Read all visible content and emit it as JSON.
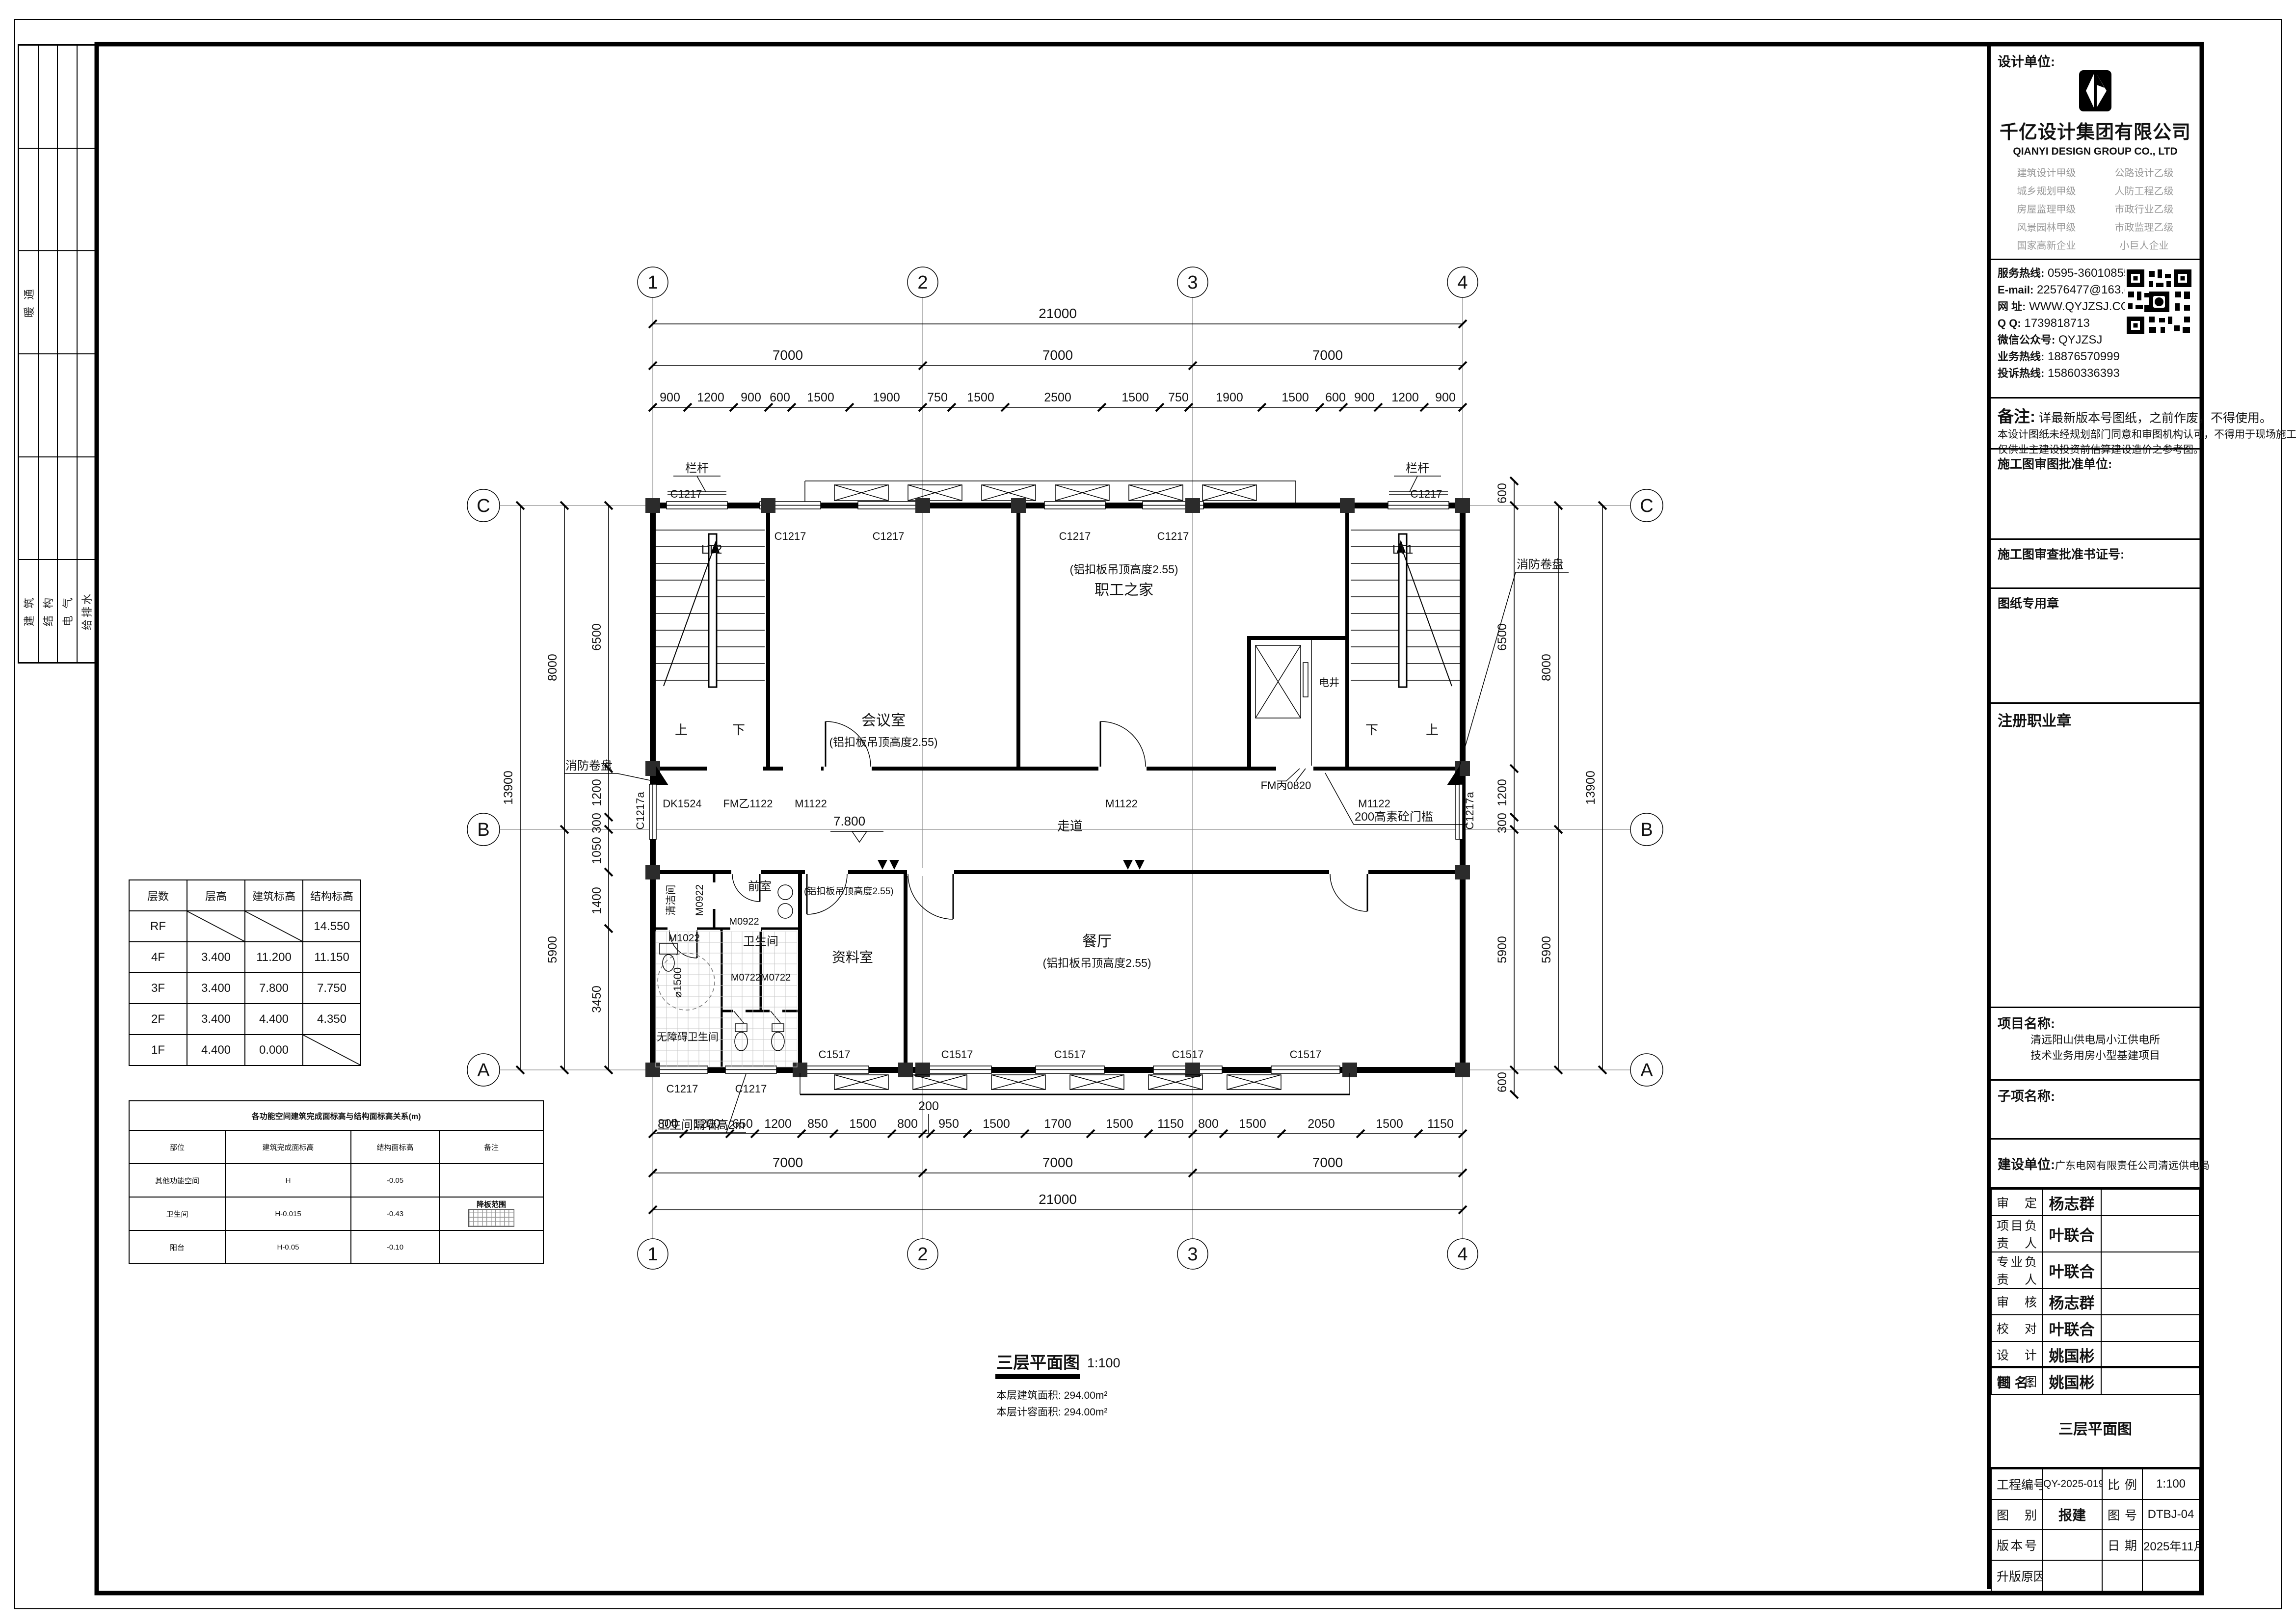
{
  "strip": {
    "hvac": "暖 通",
    "disciplines": [
      "建 筑",
      "结 构",
      "电 气",
      "给排水"
    ]
  },
  "title_block": {
    "design_unit_label": "设计单位:",
    "company_cn": "千亿设计集团有限公司",
    "company_en": "QIANYI DESIGN GROUP CO., LTD",
    "quals_left": [
      "建筑设计甲级",
      "城乡规划甲级",
      "房屋监理甲级",
      "风景园林甲级",
      "国家高新企业"
    ],
    "quals_right": [
      "公路设计乙级",
      "人防工程乙级",
      "市政行业乙级",
      "市政监理乙级",
      "小巨人企业"
    ],
    "contact": {
      "service_label": "服务热线:",
      "service": "0595-36010855",
      "email_label": "E-mail:",
      "email": "22576477@163.com",
      "web_label": "网 址:",
      "web": "WWW.QYJZSJ.COM",
      "qq_label": "Q Q:",
      "qq": "1739818713",
      "wechat_label": "微信公众号:",
      "wechat": "QYJZSJ",
      "biz_label": "业务热线:",
      "biz": "18876570999",
      "complaint_label": "投诉热线:",
      "complaint": "15860336393"
    },
    "remark_label": "备注:",
    "remark1": "详最新版本号图纸，之前作废，不得使用。",
    "remark2": "本设计图纸未经规划部门同意和审图机构认可，不得用于现场施工，",
    "remark3": "仅供业主建设投资前估算建设造价之参考图。",
    "approval_unit_label": "施工图审图批准单位:",
    "approval_no_label": "施工图审查批准书证号:",
    "seal_label": "图纸专用章",
    "reg_seal_label": "注册职业章",
    "project_label": "项目名称:",
    "project_line1": "清远阳山供电局小江供电所",
    "project_line2": "技术业务用房小型基建项目",
    "subproject_label": "子项名称:",
    "client_label": "建设单位:",
    "client": "广东电网有限责任公司清远供电局",
    "personnel": [
      {
        "role": "审定",
        "name": "杨志群"
      },
      {
        "role": "项目负责人",
        "name": "叶联合"
      },
      {
        "role": "专业负责人",
        "name": "叶联合"
      },
      {
        "role": "审核",
        "name": "杨志群"
      },
      {
        "role": "校对",
        "name": "叶联合"
      },
      {
        "role": "设计",
        "name": "姚国彬"
      },
      {
        "role": "制图",
        "name": "姚国彬"
      }
    ],
    "drawing_name_label": "图  名:",
    "drawing_name": "三层平面图",
    "bottom": {
      "project_no_label": "工程编号",
      "project_no": "QY-2025-019",
      "scale_label": "比例",
      "scale": "1:100",
      "category_label": "图别",
      "category": "报建",
      "no_label": "图号",
      "no": "DTBJ-04",
      "version_label": "版本号",
      "version": "",
      "date_label": "日期",
      "date": "2025年11月",
      "revision_label": "升版原因"
    }
  },
  "tables": {
    "floor": {
      "headers": [
        "层数",
        "层高",
        "建筑标高",
        "结构标高"
      ],
      "rows": [
        [
          "RF",
          "",
          "",
          "14.550"
        ],
        [
          "4F",
          "3.400",
          "11.200",
          "11.150"
        ],
        [
          "3F",
          "3.400",
          "7.800",
          "7.750"
        ],
        [
          "2F",
          "3.400",
          "4.400",
          "4.350"
        ],
        [
          "1F",
          "4.400",
          "0.000",
          ""
        ]
      ]
    },
    "relation": {
      "title": "各功能空间建筑完成面标高与结构面标高关系(m)",
      "headers": [
        "部位",
        "建筑完成面标高",
        "结构面标高",
        "备注"
      ],
      "rows": [
        [
          "其他功能空间",
          "H",
          "-0.05",
          ""
        ],
        [
          "卫生间",
          "H-0.015",
          "-0.43",
          "降板范围"
        ],
        [
          "阳台",
          "H-0.05",
          "-0.10",
          ""
        ]
      ]
    }
  },
  "plan": {
    "title": "三层平面图",
    "scale": "1:100",
    "area1": "本层建筑面积: 294.00m²",
    "area2": "本层计容面积: 294.00m²",
    "grid_top": [
      "1",
      "2",
      "3",
      "4"
    ],
    "grid_side": [
      "C",
      "B",
      "A"
    ],
    "dim_total": "21000",
    "dim_bay": "7000",
    "dims_top": [
      "900",
      "1200",
      "900",
      "600",
      "1500",
      "1900",
      "750",
      "1500",
      "2500",
      "1500",
      "750",
      "1900",
      "1500",
      "600",
      "900",
      "1200",
      "900"
    ],
    "dims_bottom": [
      "800",
      "1200",
      "650",
      "1200",
      "850",
      "1500",
      "800",
      "200",
      "950",
      "1500",
      "1700",
      "1500",
      "1150",
      "800",
      "1500",
      "2050",
      "1500",
      "1150"
    ],
    "dims_left": [
      "6500",
      "1200",
      "300",
      "1050",
      "1400",
      "3450"
    ],
    "dims_right": [
      "600",
      "6500",
      "1200",
      "300",
      "5900",
      "600"
    ],
    "dims_lr_mid": [
      "8000",
      "5900"
    ],
    "dim_lr_total": "13900",
    "rooms": {
      "meeting": "会议室",
      "ceiling": "(铝扣板吊顶高度2.55)",
      "staff": "职工之家",
      "archive": "资料室",
      "dining": "餐厅",
      "corridor": "走道",
      "level": "7.800",
      "lt1": "LT1",
      "lt2": "LT2",
      "up": "上",
      "down": "下",
      "shaft": "电井",
      "clean": "清洁间",
      "ante": "前室",
      "wc": "卫生间",
      "acc": "无障碍卫生间"
    },
    "ann": {
      "railing": "栏杆",
      "fire": "消防卷盘",
      "threshold": "200高素砼门槛",
      "wcwall": "卫生间隔墙高2m",
      "dia": "⌀1500",
      "fmb": "FM丙0820",
      "fmy": "FM乙1122",
      "dk": "DK1524",
      "m1122": "M1122",
      "m0922": "M0922",
      "m1022": "M1022",
      "m0722": "M0722M0722",
      "c1217": "C1217",
      "c1217a": "C1217a",
      "c1517": "C1517"
    }
  }
}
